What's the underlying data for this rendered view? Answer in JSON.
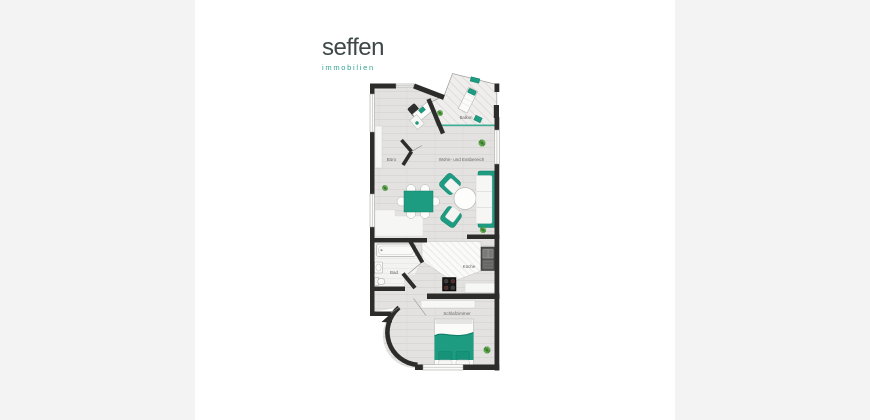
{
  "brand": {
    "name": "seffen",
    "tagline": "immobilien"
  },
  "floorplan": {
    "rooms": [
      {
        "name": "Balkon"
      },
      {
        "name": "Büro"
      },
      {
        "name": "Wohn- und Essbereich"
      },
      {
        "name": "Bad"
      },
      {
        "name": "Küche"
      },
      {
        "name": "Schlafzimmer"
      }
    ],
    "colors": {
      "accent_teal": "#1d9c81",
      "wall": "#2c2c2a",
      "floor": "#e3e2e0",
      "plant_green": "#5da04b",
      "brand_name": "#3e4749",
      "brand_tagline": "#2ea392",
      "margin_gray": "#f3f3f3"
    }
  }
}
